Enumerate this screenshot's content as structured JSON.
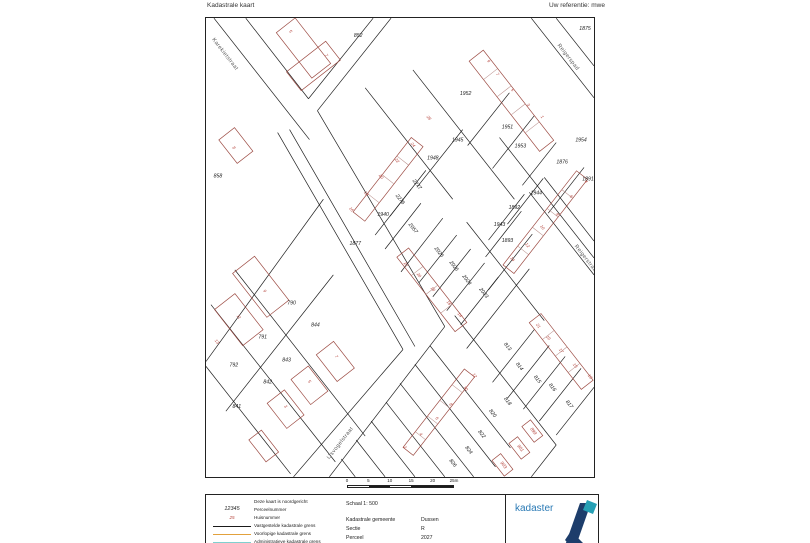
{
  "header": {
    "title": "Kadastrale kaart",
    "reference": "Uw referentie: mwe"
  },
  "colors": {
    "boundary": "#1f1f1f",
    "building": "#9c4a42",
    "house_number": "#b5433b",
    "street_name": "#555555",
    "legend_orange": "#e2a13c",
    "legend_cyan": "#7fd0cf",
    "logo_blue": "#2a7ab5",
    "logo_dark": "#1d3d6b",
    "logo_teal": "#26a0b5"
  },
  "map": {
    "streets": [
      {
        "n": "Karekietstraat",
        "x": 18,
        "y": 37,
        "r": 52
      },
      {
        "n": "Reigerspad",
        "x": 363,
        "y": 40,
        "r": 52
      },
      {
        "n": "Reigerstraat",
        "x": 381,
        "y": 243,
        "r": 52
      },
      {
        "n": "IJsvogelstraat",
        "x": 136,
        "y": 428,
        "r": -52
      }
    ],
    "parcels": [
      {
        "n": "852",
        "x": 153,
        "y": 19,
        "r": 0
      },
      {
        "n": "1875",
        "x": 381,
        "y": 12,
        "r": 0
      },
      {
        "n": "858",
        "x": 12,
        "y": 160,
        "r": 0
      },
      {
        "n": "1952",
        "x": 261,
        "y": 77,
        "r": 0
      },
      {
        "n": "1951",
        "x": 303,
        "y": 111,
        "r": 0
      },
      {
        "n": "1953",
        "x": 316,
        "y": 130,
        "r": 0
      },
      {
        "n": "1954",
        "x": 377,
        "y": 124,
        "r": 0
      },
      {
        "n": "1945",
        "x": 253,
        "y": 124,
        "r": 0
      },
      {
        "n": "1948",
        "x": 228,
        "y": 142,
        "r": 0
      },
      {
        "n": "1876",
        "x": 358,
        "y": 146,
        "r": 0
      },
      {
        "n": "1891",
        "x": 384,
        "y": 163,
        "r": 0
      },
      {
        "n": "1944",
        "x": 332,
        "y": 177,
        "r": 0
      },
      {
        "n": "1892",
        "x": 310,
        "y": 192,
        "r": 0
      },
      {
        "n": "1943",
        "x": 295,
        "y": 209,
        "r": 0
      },
      {
        "n": "1893",
        "x": 303,
        "y": 225,
        "r": 0
      },
      {
        "n": "2277",
        "x": 211,
        "y": 168,
        "r": 52
      },
      {
        "n": "2276",
        "x": 194,
        "y": 183,
        "r": 52
      },
      {
        "n": "1940",
        "x": 178,
        "y": 199,
        "r": 0
      },
      {
        "n": "2057",
        "x": 207,
        "y": 212,
        "r": 52
      },
      {
        "n": "1877",
        "x": 150,
        "y": 228,
        "r": 0
      },
      {
        "n": "2026",
        "x": 233,
        "y": 236,
        "r": 52
      },
      {
        "n": "2025",
        "x": 248,
        "y": 250,
        "r": 52
      },
      {
        "n": "2024",
        "x": 261,
        "y": 264,
        "r": 52
      },
      {
        "n": "2023",
        "x": 278,
        "y": 277,
        "r": 52
      },
      {
        "n": "790",
        "x": 86,
        "y": 288,
        "r": 0
      },
      {
        "n": "844",
        "x": 110,
        "y": 310,
        "r": 0
      },
      {
        "n": "791",
        "x": 57,
        "y": 322,
        "r": 0
      },
      {
        "n": "843",
        "x": 81,
        "y": 345,
        "r": 0
      },
      {
        "n": "792",
        "x": 28,
        "y": 350,
        "r": 0
      },
      {
        "n": "842",
        "x": 62,
        "y": 367,
        "r": 0
      },
      {
        "n": "841",
        "x": 31,
        "y": 392,
        "r": 0
      },
      {
        "n": "813",
        "x": 302,
        "y": 331,
        "r": 52
      },
      {
        "n": "814",
        "x": 314,
        "y": 351,
        "r": 52
      },
      {
        "n": "815",
        "x": 332,
        "y": 364,
        "r": 52
      },
      {
        "n": "816",
        "x": 347,
        "y": 372,
        "r": 52
      },
      {
        "n": "817",
        "x": 364,
        "y": 389,
        "r": 52
      },
      {
        "n": "818",
        "x": 302,
        "y": 386,
        "r": 52
      },
      {
        "n": "820",
        "x": 287,
        "y": 398,
        "r": 52
      },
      {
        "n": "822",
        "x": 276,
        "y": 419,
        "r": 52
      },
      {
        "n": "824",
        "x": 263,
        "y": 435,
        "r": 52
      },
      {
        "n": "826",
        "x": 247,
        "y": 448,
        "r": 52
      }
    ],
    "red_parcels": [
      {
        "n": "899",
        "x": 328,
        "y": 416,
        "r": 52
      },
      {
        "n": "901",
        "x": 315,
        "y": 433,
        "r": 52
      },
      {
        "n": "903",
        "x": 298,
        "y": 450,
        "r": 52
      }
    ],
    "houses": [
      {
        "n": "5",
        "x": 84,
        "y": 14,
        "r": 52
      },
      {
        "n": "7",
        "x": 120,
        "y": 38,
        "r": 52
      },
      {
        "n": "8",
        "x": 27,
        "y": 131,
        "r": 52
      },
      {
        "n": "9",
        "x": 283,
        "y": 44,
        "r": 52
      },
      {
        "n": "7",
        "x": 292,
        "y": 57,
        "r": 52
      },
      {
        "n": "5",
        "x": 307,
        "y": 73,
        "r": 52
      },
      {
        "n": "3",
        "x": 323,
        "y": 88,
        "r": 52
      },
      {
        "n": "1",
        "x": 337,
        "y": 100,
        "r": 52
      },
      {
        "n": "26",
        "x": 223,
        "y": 101,
        "r": 52
      },
      {
        "n": "24",
        "x": 207,
        "y": 128,
        "r": 52
      },
      {
        "n": "22",
        "x": 191,
        "y": 144,
        "r": 52
      },
      {
        "n": "20",
        "x": 175,
        "y": 160,
        "r": 52
      },
      {
        "n": "18",
        "x": 160,
        "y": 177,
        "r": 52
      },
      {
        "n": "16",
        "x": 145,
        "y": 193,
        "r": 52
      },
      {
        "n": "22",
        "x": 200,
        "y": 248,
        "r": 52
      },
      {
        "n": "20",
        "x": 213,
        "y": 259,
        "r": 52
      },
      {
        "n": "18",
        "x": 227,
        "y": 273,
        "r": 52
      },
      {
        "n": "16",
        "x": 243,
        "y": 287,
        "r": 52
      },
      {
        "n": "14",
        "x": 254,
        "y": 299,
        "r": 52
      },
      {
        "n": "9",
        "x": 58,
        "y": 275,
        "r": 52
      },
      {
        "n": "11",
        "x": 32,
        "y": 301,
        "r": 52
      },
      {
        "n": "13",
        "x": 10,
        "y": 326,
        "r": 52
      },
      {
        "n": "7",
        "x": 130,
        "y": 341,
        "r": 52
      },
      {
        "n": "5",
        "x": 103,
        "y": 366,
        "r": 52
      },
      {
        "n": "3",
        "x": 79,
        "y": 391,
        "r": 52
      },
      {
        "n": "4",
        "x": 381,
        "y": 165,
        "r": 52
      },
      {
        "n": "6",
        "x": 366,
        "y": 180,
        "r": 52
      },
      {
        "n": "8",
        "x": 352,
        "y": 198,
        "r": 52
      },
      {
        "n": "10",
        "x": 337,
        "y": 211,
        "r": 52
      },
      {
        "n": "12",
        "x": 322,
        "y": 229,
        "r": 52
      },
      {
        "n": "14",
        "x": 307,
        "y": 243,
        "r": 52
      },
      {
        "n": "21",
        "x": 333,
        "y": 310,
        "r": 52
      },
      {
        "n": "19",
        "x": 343,
        "y": 322,
        "r": 52
      },
      {
        "n": "17",
        "x": 356,
        "y": 335,
        "r": 52
      },
      {
        "n": "15",
        "x": 370,
        "y": 350,
        "r": 52
      },
      {
        "n": "13",
        "x": 385,
        "y": 361,
        "r": 52
      },
      {
        "n": "12",
        "x": 269,
        "y": 360,
        "r": 52
      },
      {
        "n": "10",
        "x": 260,
        "y": 373,
        "r": 52
      },
      {
        "n": "8",
        "x": 245,
        "y": 389,
        "r": 52
      },
      {
        "n": "6",
        "x": 231,
        "y": 403,
        "r": 52
      },
      {
        "n": "4",
        "x": 215,
        "y": 419,
        "r": 52
      },
      {
        "n": "2",
        "x": 199,
        "y": 432,
        "r": 52
      }
    ]
  },
  "scalebar": {
    "labels": [
      "0",
      "5",
      "10",
      "15",
      "20",
      "25m"
    ]
  },
  "legend": {
    "north_note": "Deze kaart is noordgericht",
    "parcel_sym": "12345",
    "house_sym": "25",
    "items": [
      {
        "label": "Perceelnummer"
      },
      {
        "label": "Huisnummer"
      },
      {
        "label": "Vastgestelde kadastrale grens"
      },
      {
        "label": "Voorlopige kadastrale grens"
      },
      {
        "label": "Administratieve kadastrale grens"
      }
    ]
  },
  "info": {
    "schaal": "Schaal 1: 500",
    "items": [
      {
        "label": "Kadastrale gemeente",
        "value": "Dussen"
      },
      {
        "label": "Sectie",
        "value": "R"
      },
      {
        "label": "Perceel",
        "value": "2027"
      }
    ]
  },
  "logo": {
    "word": "kadaster"
  }
}
